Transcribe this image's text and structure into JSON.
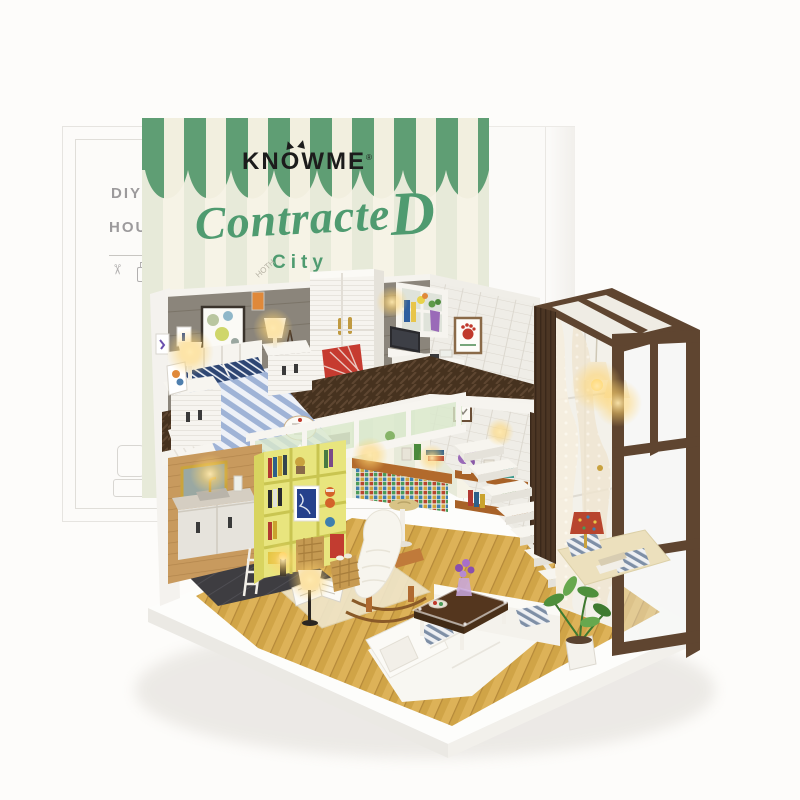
{
  "scene": {
    "alt": "DIY miniature loft dollhouse model displayed in front of its green striped packaging box"
  },
  "packaging": {
    "brand": "KNOWME",
    "trademark": "®",
    "title_main": "Contracte",
    "title_cap": "D",
    "subtitle": "City",
    "small_print": "HOTH",
    "left_box": {
      "line1": "DIY",
      "line2": "HOUSE"
    },
    "colors": {
      "awning_green": "#5f9e74",
      "awning_cream": "#f2efdf",
      "body_stripe_a": "#e7ead9",
      "body_stripe_b": "#f6f3e6",
      "title_green": "#4f9b70"
    }
  },
  "model": {
    "colors": {
      "wall_gray": "#8b857b",
      "brick_white": "#efede7",
      "shelf_yellow": "#e8e57e",
      "floor_a": "#ddb258",
      "floor_b": "#d0a447",
      "loft_floor": "#46321f",
      "frame_brown": "#5f4530",
      "sofa_white": "#f8f7f2",
      "chair_red": "#c63b30",
      "bed_blue": "#9fb3d6",
      "glow": "#ffd867"
    },
    "parts": [
      "loft-bedroom",
      "striped-bed",
      "nightstand-lamps",
      "louver-wardrobe",
      "plaid-armchair",
      "eiffel-tower-figurine",
      "desk-with-laptop",
      "glass-loft-railing",
      "floating-stairs",
      "yellow-bookshelf",
      "bathroom-vanity",
      "kitchenette-mosaic-counter",
      "wall-shelves",
      "window-frame-string-lights",
      "lace-curtain",
      "reading-nook-cushions",
      "rocking-chair",
      "open-book",
      "floor-lamp",
      "corner-sofa",
      "coffee-table",
      "potted-plant"
    ]
  }
}
